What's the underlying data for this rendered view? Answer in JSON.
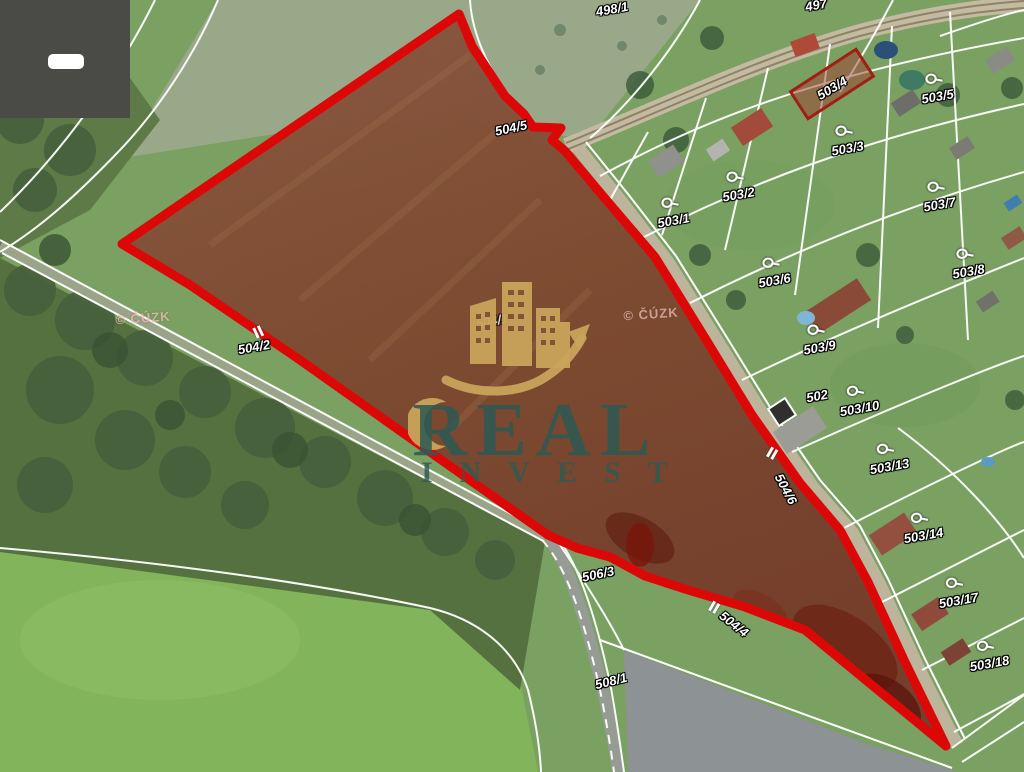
{
  "branding": {
    "wordmark_line1": "REAL",
    "wordmark_line2": "INVEST"
  },
  "colors": {
    "highlight_red": "#dc0808",
    "parcel_fill_brown": "#7e4a34",
    "logo_gold": "#c9a35b",
    "wordmark_teal": "#2d5a54",
    "cadastral_line": "#ffffff"
  },
  "map": {
    "copyright_watermarks": [
      {
        "text": "© ČÚZK",
        "x": 143,
        "y": 318,
        "rot": -4
      },
      {
        "text": "© ČÚZK",
        "x": 651,
        "y": 314,
        "rot": -4
      }
    ],
    "parcel_labels": [
      {
        "text": "498/1",
        "x": 612,
        "y": 9,
        "rot": -10,
        "icon": false
      },
      {
        "text": "497",
        "x": 816,
        "y": 5,
        "rot": -10,
        "icon": false
      },
      {
        "text": "503/4",
        "x": 832,
        "y": 88,
        "rot": -31,
        "icon": false
      },
      {
        "text": "503/5",
        "x": 936,
        "y": 88,
        "rot": -10,
        "icon": true
      },
      {
        "text": "503/3",
        "x": 846,
        "y": 140,
        "rot": -10,
        "icon": true
      },
      {
        "text": "503/2",
        "x": 737,
        "y": 186,
        "rot": -10,
        "icon": true
      },
      {
        "text": "503/1",
        "x": 672,
        "y": 212,
        "rot": -10,
        "icon": true
      },
      {
        "text": "503/7",
        "x": 938,
        "y": 196,
        "rot": -10,
        "icon": true
      },
      {
        "text": "503/6",
        "x": 773,
        "y": 272,
        "rot": -10,
        "icon": true
      },
      {
        "text": "503/8",
        "x": 967,
        "y": 263,
        "rot": -10,
        "icon": true
      },
      {
        "text": "504/5",
        "x": 511,
        "y": 128,
        "rot": -12,
        "icon": false
      },
      {
        "text": "504/2",
        "x": 254,
        "y": 347,
        "rot": -10,
        "icon": false
      },
      {
        "text": "504/1",
        "x": 492,
        "y": 321,
        "rot": -10,
        "icon": false,
        "faint": true
      },
      {
        "text": "503/9",
        "x": 818,
        "y": 339,
        "rot": -10,
        "icon": true
      },
      {
        "text": "502",
        "x": 817,
        "y": 396,
        "rot": -10,
        "icon": false
      },
      {
        "text": "503/10",
        "x": 858,
        "y": 400,
        "rot": -10,
        "icon": true
      },
      {
        "text": "503/13",
        "x": 888,
        "y": 458,
        "rot": -10,
        "icon": true
      },
      {
        "text": "504/6",
        "x": 786,
        "y": 489,
        "rot": 62,
        "icon": false
      },
      {
        "text": "503/14",
        "x": 922,
        "y": 527,
        "rot": -10,
        "icon": true
      },
      {
        "text": "503/17",
        "x": 957,
        "y": 592,
        "rot": -10,
        "icon": true
      },
      {
        "text": "503/18",
        "x": 988,
        "y": 655,
        "rot": -10,
        "icon": true
      },
      {
        "text": "506/3",
        "x": 598,
        "y": 574,
        "rot": -12,
        "icon": false
      },
      {
        "text": "504/4",
        "x": 734,
        "y": 624,
        "rot": 38,
        "icon": false
      },
      {
        "text": "508/1",
        "x": 611,
        "y": 681,
        "rot": -14,
        "icon": false
      }
    ],
    "tick_marks": [
      {
        "x": 256,
        "y": 333,
        "rot": -25
      },
      {
        "x": 770,
        "y": 452,
        "rot": 30
      },
      {
        "x": 712,
        "y": 606,
        "rot": 30
      }
    ]
  }
}
